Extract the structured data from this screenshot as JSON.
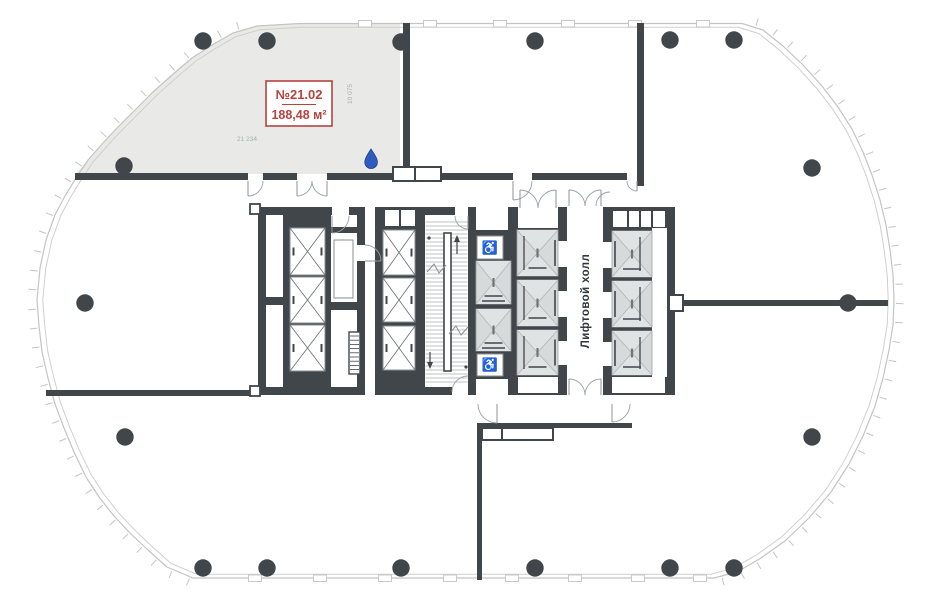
{
  "page": {
    "title": "floor-plan",
    "background": "#ffffff"
  },
  "unit": {
    "number": "№21.02",
    "area": "188,48 м²"
  },
  "dimensions": {
    "width": "21 234",
    "depth": "10 075"
  },
  "labels": {
    "elevator_hall": "Лифтовой холл"
  },
  "icons": {
    "wheelchair": "♿",
    "water_drop": "water-drop-icon"
  },
  "watermark": "Н",
  "colors": {
    "wall": "#41464b",
    "facade": "#c4c4c4",
    "unit_fill": "#e9e9e7",
    "cab_fill": "#d7dadb",
    "cab_shade": "#e0e3e4",
    "accent_red": "#b5433e",
    "dim_text": "#a8adb0",
    "hall_text": "#32373c",
    "column": "#41464b",
    "drop_blue": "#2e5dbd",
    "door_arc": "#9aa0a4"
  }
}
